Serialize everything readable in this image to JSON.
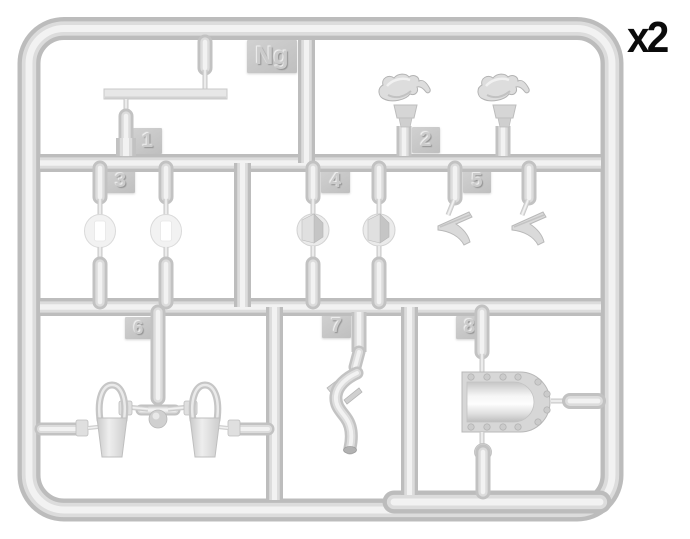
{
  "sprue": {
    "code": "Ng",
    "quantity_label": "x2",
    "part_tags": {
      "t1": "1",
      "t2": "2",
      "t3": "3",
      "t4": "4",
      "t5": "5",
      "t6": "6",
      "t7": "7",
      "t8": "8"
    },
    "parts": [
      {
        "tag": "1",
        "shape": "long flat rod"
      },
      {
        "tag": "2",
        "shape": "towing-hook piece, two copies"
      },
      {
        "tag": "3",
        "shape": "round disc with slot, two copies"
      },
      {
        "tag": "4",
        "shape": "round pad with wedge, two copies"
      },
      {
        "tag": "5",
        "shape": "angled bracket, two copies"
      },
      {
        "tag": "6",
        "shape": "shackle loop, two copies"
      },
      {
        "tag": "7",
        "shape": "curved exhaust pipe"
      },
      {
        "tag": "8",
        "shape": "riveted rounded cover"
      }
    ],
    "colors": {
      "background": "#ffffff",
      "plastic_edge": "#bdbdbd",
      "plastic_mid": "#dcdcdc",
      "plastic_highlight": "#f2f2f2",
      "tag_plate": "#c7c7c7",
      "quantity_text": "#0b0b0b"
    }
  }
}
